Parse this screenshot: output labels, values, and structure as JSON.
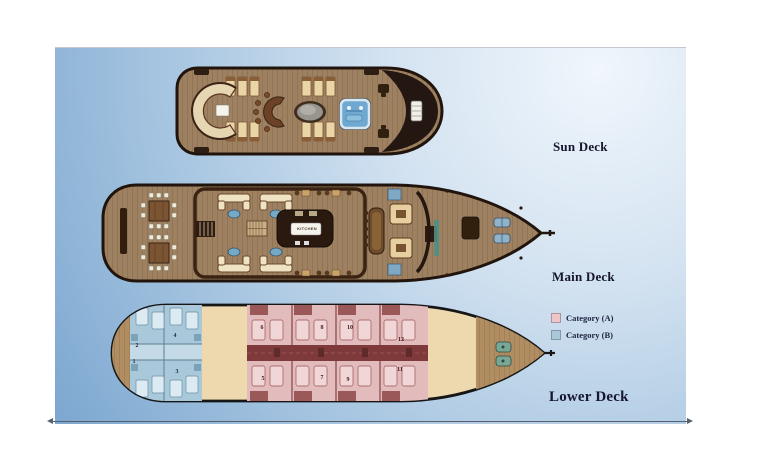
{
  "decks": {
    "sun": {
      "label": "Sun Deck"
    },
    "main": {
      "label": "Main Deck",
      "kitchen": "KITCHEN"
    },
    "lower": {
      "label": "Lower Deck",
      "cabins": [
        {
          "n": "1"
        },
        {
          "n": "2"
        },
        {
          "n": "3"
        },
        {
          "n": "4"
        },
        {
          "n": "5"
        },
        {
          "n": "6"
        },
        {
          "n": "7"
        },
        {
          "n": "8"
        },
        {
          "n": "9"
        },
        {
          "n": "10"
        },
        {
          "n": "11"
        },
        {
          "n": "12"
        }
      ]
    }
  },
  "legend": {
    "items": [
      {
        "label": "Category (A)",
        "swatch": "#efc5c7"
      },
      {
        "label": "Category (B)",
        "swatch": "#a9c9da"
      }
    ]
  }
}
